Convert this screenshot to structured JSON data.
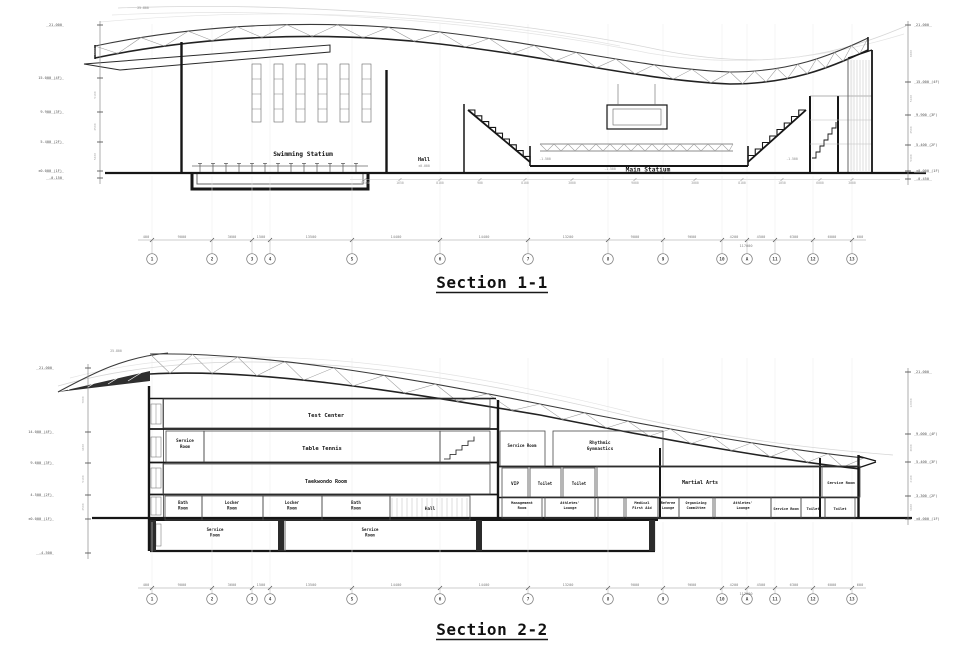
{
  "sheet": {
    "background": "#ffffff",
    "line_color": "#1a1a1a"
  },
  "section1": {
    "title": "Section 1-1",
    "labels": {
      "swimming": "Swimming Statium",
      "hall": "Hall",
      "hall_level": "±0.000",
      "main": "Main Statium",
      "main_level": "-1.500",
      "peak": "25.800"
    },
    "left_levels": [
      "21.000",
      "15.000 (4F)",
      "9.900 (3F)",
      "5.400 (2F)",
      "±0.000 (1F)",
      "-0.150"
    ],
    "left_segs": [
      "6000",
      "5100",
      "4500",
      "5400"
    ],
    "right_levels": [
      "21.000",
      "15.000 (4F)",
      "9.900 (3F)",
      "5.400 (2F)",
      "±0.000 (1F)",
      "-0.450"
    ],
    "right_segs": [
      "6000",
      "5100",
      "4500",
      "5400"
    ],
    "grid_bubbles": [
      "1",
      "2",
      "3",
      "4",
      "5",
      "6",
      "7",
      "8",
      "9",
      "10",
      "A",
      "11",
      "12",
      "13"
    ],
    "dims": [
      "400",
      "9000",
      "3600",
      "1500",
      "13500",
      "14400",
      "14400",
      "13200",
      "9000",
      "9600",
      "4200",
      "4500",
      "6300",
      "6000",
      "600"
    ],
    "total": "117000",
    "sub_dims": [
      "10500",
      "1650",
      "8100",
      "900",
      "8100",
      "3000",
      "9000",
      "3000",
      "8100",
      "1050",
      "6000",
      "3000"
    ]
  },
  "section2": {
    "title": "Section 2-2",
    "labels": {
      "peak": "25.800"
    },
    "rooms": {
      "test_center": "Test Center",
      "service_room_3f": "Service Room",
      "table_tennis": "Table Tennis",
      "taekwondo": "Taekwondo Room",
      "bath_room_1": "Bath Room",
      "locker_room_1": "Locker Room",
      "locker_room_2": "Locker Room",
      "bath_room_2": "Bath Room",
      "hall": "Hall",
      "service_room_b1": "Service Room",
      "service_room_b2": "Service Room",
      "service_room_2f": "Service Room",
      "rhythmic": "Rhythmic Gymnastics",
      "vip": "VIP",
      "toilet_1": "Toilet",
      "toilet_2": "Toilet",
      "martial_arts": "Martial Arts",
      "service_room_e": "Service Room",
      "management": "Management Room",
      "athletes_1": "Athletes' Lounge",
      "medical": "Medical First Aid",
      "referee": "Referee Lounge",
      "organizing": "Organizing Committee",
      "athletes_2": "Athletes' Lounge",
      "service_room_g": "Service Room",
      "toilet_3": "Toilet",
      "toilet_4": "Toilet"
    },
    "left_levels": [
      "21.000",
      "14.000 (4F)",
      "9.600 (3F)",
      "4.500 (2F)",
      "±0.000 (1F)",
      "-4.500"
    ],
    "left_segs": [
      "7000",
      "4400",
      "5100",
      "4500"
    ],
    "right_levels": [
      "21.000",
      "9.000 (4F)",
      "5.400 (3F)",
      "3.300 (2F)",
      "±0.000 (1F)"
    ],
    "right_segs": [
      "12000",
      "3600",
      "2100",
      "3300"
    ],
    "grid_bubbles": [
      "1",
      "2",
      "3",
      "4",
      "5",
      "6",
      "7",
      "8",
      "9",
      "10",
      "A",
      "11",
      "12",
      "13"
    ],
    "dims": [
      "400",
      "9000",
      "3600",
      "1500",
      "13500",
      "14400",
      "14400",
      "13200",
      "9000",
      "9600",
      "4200",
      "4500",
      "6300",
      "6000",
      "600"
    ],
    "total": "117000"
  }
}
